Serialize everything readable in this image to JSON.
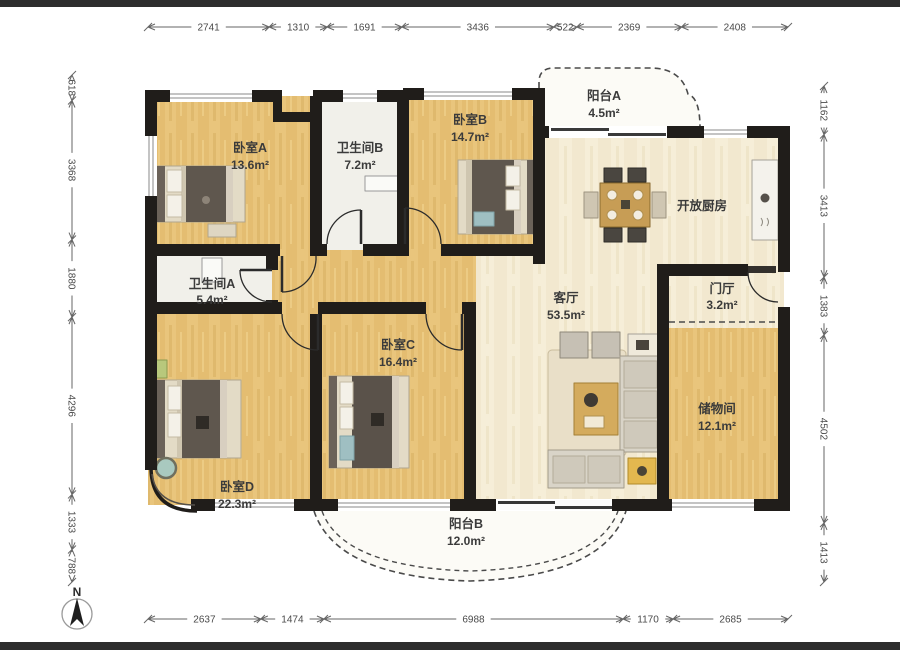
{
  "rooms": {
    "bedroomA": {
      "name": "卧室A",
      "area": "13.6m²"
    },
    "bathroomB": {
      "name": "卫生间B",
      "area": "7.2m²"
    },
    "bedroomB": {
      "name": "卧室B",
      "area": "14.7m²"
    },
    "balconyA": {
      "name": "阳台A",
      "area": "4.5m²"
    },
    "kitchen": {
      "name": "开放厨房"
    },
    "bathroomA": {
      "name": "卫生间A",
      "area": "5.4m²"
    },
    "livingRoom": {
      "name": "客厅",
      "area": "53.5m²"
    },
    "foyer": {
      "name": "门厅",
      "area": "3.2m²"
    },
    "bedroomC": {
      "name": "卧室C",
      "area": "16.4m²"
    },
    "storage": {
      "name": "储物间",
      "area": "12.1m²"
    },
    "bedroomD": {
      "name": "卧室D",
      "area": "22.3m²"
    },
    "balconyB": {
      "name": "阳台B",
      "area": "12.0m²"
    }
  },
  "dimensions": {
    "top": [
      "2741",
      "1310",
      "1691",
      "3436",
      "522",
      "2369",
      "2408"
    ],
    "bottom": [
      "2637",
      "1474",
      "6988",
      "1170",
      "2685"
    ],
    "left": [
      "618",
      "3368",
      "1880",
      "4296",
      "1333",
      "788"
    ],
    "right": [
      "1162",
      "3413",
      "1383",
      "4502",
      "1413"
    ]
  },
  "compass": {
    "label": "N"
  },
  "colors": {
    "wall": "#201d1a",
    "floor_wood": "#e9c57c",
    "floor_cream": "#f6eed8",
    "floor_white": "#f1f0ea",
    "accent_teal": "#9fbfc2",
    "dim_line": "#666666"
  }
}
